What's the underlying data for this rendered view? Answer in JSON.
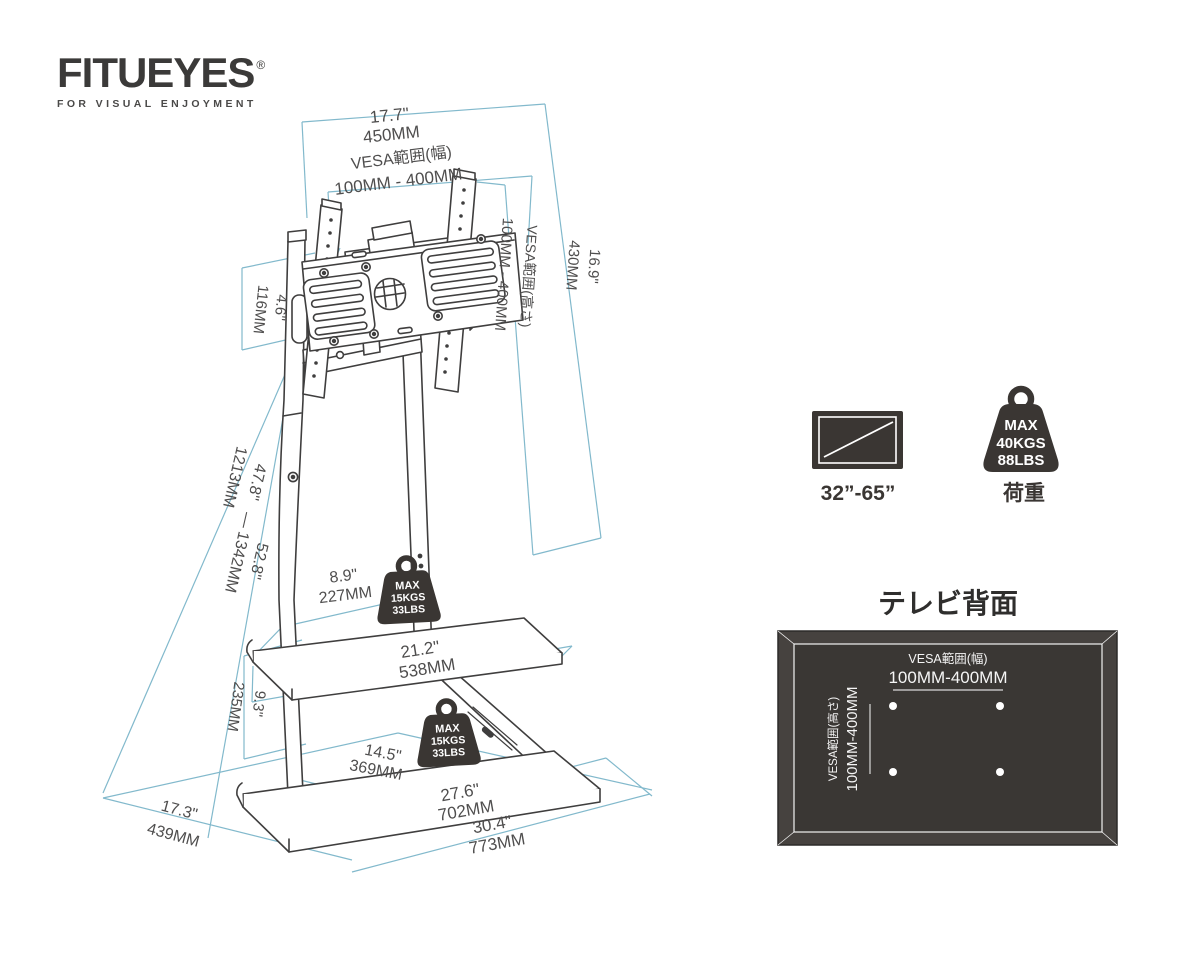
{
  "brand": {
    "name": "FITUEYES",
    "registered_mark": "®",
    "tagline": "FOR VISUAL ENJOYMENT"
  },
  "stand_diagram": {
    "top_width": {
      "inches": "17.7\"",
      "mm": "450MM"
    },
    "vesa_width": {
      "label": "VESA範囲(幅)",
      "range": "100MM - 400MM"
    },
    "vesa_height": {
      "label": "VESA範囲(高さ)",
      "range": "100MM - 400MM"
    },
    "bracket_height": {
      "inches": "16.9\"",
      "mm": "430MM"
    },
    "bracket_offset": {
      "inches": "4.6\"",
      "mm": "116MM"
    },
    "stand_height": {
      "min_inches": "47.8\"",
      "min_mm": "1213MM",
      "separator": "—",
      "max_inches": "52.8\"",
      "max_mm": "1342MM"
    },
    "shelf_gap": {
      "inches": "9.3\"",
      "mm": "235MM"
    },
    "middle_shelf_depth": {
      "inches": "8.9\"",
      "mm": "227MM"
    },
    "middle_shelf_width": {
      "inches": "21.2\"",
      "mm": "538MM"
    },
    "bottom_shelf_depth": {
      "inches": "14.5\"",
      "mm": "369MM"
    },
    "base_width": {
      "inches": "27.6\"",
      "mm": "702MM"
    },
    "base_outer_width": {
      "inches": "30.4\"",
      "mm": "773MM"
    },
    "base_depth": {
      "inches": "17.3\"",
      "mm": "439MM"
    },
    "shelf_load_badge": {
      "max": "MAX",
      "kgs": "15KGS",
      "lbs": "33LBS"
    }
  },
  "compatibility": {
    "screen_size": "32”-65”",
    "load_badge": {
      "max": "MAX",
      "kgs": "40KGS",
      "lbs": "88LBS"
    },
    "load_label": "荷重"
  },
  "tv_back_panel": {
    "title": "テレビ背面",
    "vesa_width": {
      "label": "VESA範囲(幅)",
      "range": "100MM-400MM"
    },
    "vesa_height": {
      "label": "VESA範囲(高さ)",
      "range": "100MM-400MM"
    }
  },
  "colors": {
    "dimension_line": "#82b9cc",
    "drawing_line": "#3f3e3e",
    "dark_fill": "#3a3633",
    "label_text": "#4f4e4e"
  }
}
